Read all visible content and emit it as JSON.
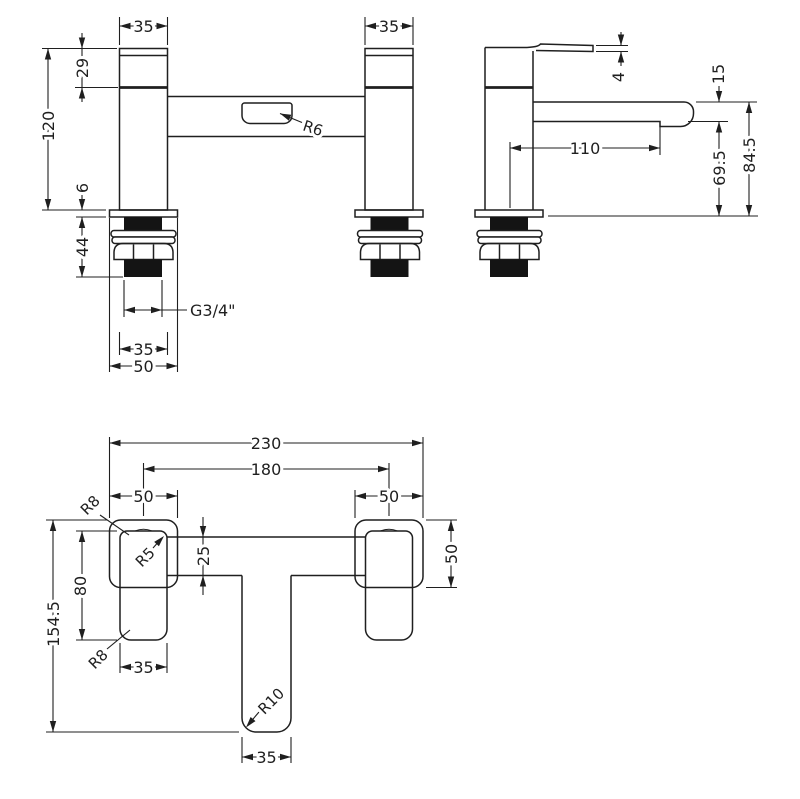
{
  "drawing": {
    "type": "technical-orthographic-drawing",
    "subject": "bath-filler-tap",
    "colors": {
      "line": "#1f1f1f",
      "background": "#ffffff"
    },
    "views": {
      "front": {
        "dims": {
          "pillar_width_left": "35",
          "pillar_width_right": "35",
          "head_height": "29",
          "body_height": "120",
          "deck_plate_thickness": "6",
          "tail_length": "44",
          "thread_spec": "G3/4\"",
          "thread_width": "35",
          "base_width": "50",
          "slot_radius": "R6"
        }
      },
      "side": {
        "dims": {
          "lever_thickness": "4",
          "spout_thickness": "15",
          "spout_reach": "110",
          "height_to_spout_underside": "69.5",
          "height_to_spout_top": "84.5"
        }
      },
      "plan": {
        "dims": {
          "overall_width": "230",
          "tap_centres": "180",
          "base_width_left": "50",
          "base_width_right": "50",
          "base_depth": "50",
          "overall_depth": "154.5",
          "handle_length": "80",
          "bar_width": "25",
          "handle_width": "35",
          "spout_width": "35",
          "radius_base_corner_top": "R8",
          "radius_handle_corner": "R5",
          "radius_base_corner_bottom": "R8",
          "radius_spout_end": "R10"
        }
      }
    }
  }
}
